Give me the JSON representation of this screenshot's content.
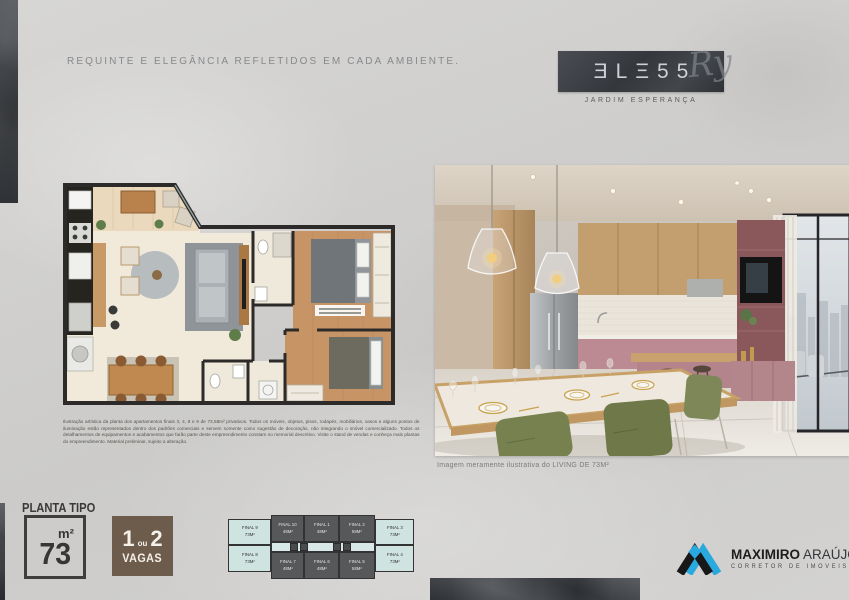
{
  "headline": {
    "text": "REQUINTE E ELEGÂNCIA REFLETIDOS EM CADA AMBIENTE."
  },
  "brand": {
    "display_letters": "ƎLΞ55",
    "name": "BLESS",
    "monogram": "Ry",
    "subtitle": "JARDIM ESPERANÇA",
    "box_color": "#3e4146"
  },
  "floorplan": {
    "disclaimer": "Ilustração artística da planta dos apartamentos finais 3, 4, 8 e 9 de 73,68m² privativos. Todos os móveis, objetos, pisos, rodapés, mobiliários, vasos e alguns pontos de iluminação estão representados dentro dos padrões comerciais e servem somente como sugestão de decoração, não integrando o imóvel comercializado. Todos os detalhamentos de equipamentos e acabamentos que farão parte deste empreendimento constam no memorial descritivo. Visite o stand de vendas e conheça mais plantas do empreendimento. Material preliminar, sujeito a alteração."
  },
  "photo": {
    "caption": "Imagem meramente ilustrativa do LIVING DE 73M²"
  },
  "planta": {
    "heading": "PLANTA TIPO",
    "unit": "m²",
    "area": "73",
    "vagas": {
      "n1": "1",
      "ou": "ou",
      "n2": "2",
      "word": "VAGAS"
    },
    "vagas_box_color": "#6d5b4c"
  },
  "keyplan": {
    "light_color": "#cfe3e1",
    "dark_color": "#57585a",
    "units": [
      {
        "label": "FINAL 9",
        "area": "73M²"
      },
      {
        "label": "FINAL 10",
        "area": "48M²"
      },
      {
        "label": "FINAL 1",
        "area": "48M²"
      },
      {
        "label": "FINAL 2",
        "area": "58M²"
      },
      {
        "label": "FINAL 3",
        "area": "73M²"
      },
      {
        "label": "FINAL 8",
        "area": "73M²"
      },
      {
        "label": "FINAL 7",
        "area": "48M²"
      },
      {
        "label": "FINAL 6",
        "area": "48M²"
      },
      {
        "label": "FINAL 5",
        "area": "58M²"
      },
      {
        "label": "FINAL 4",
        "area": "73M²"
      }
    ]
  },
  "realtor": {
    "name_strong": "MAXIMIRO",
    "name_light": "ARAÚJO",
    "tagline": "CORRETOR DE IMÓVEIS",
    "accent_color": "#2aa9df"
  }
}
